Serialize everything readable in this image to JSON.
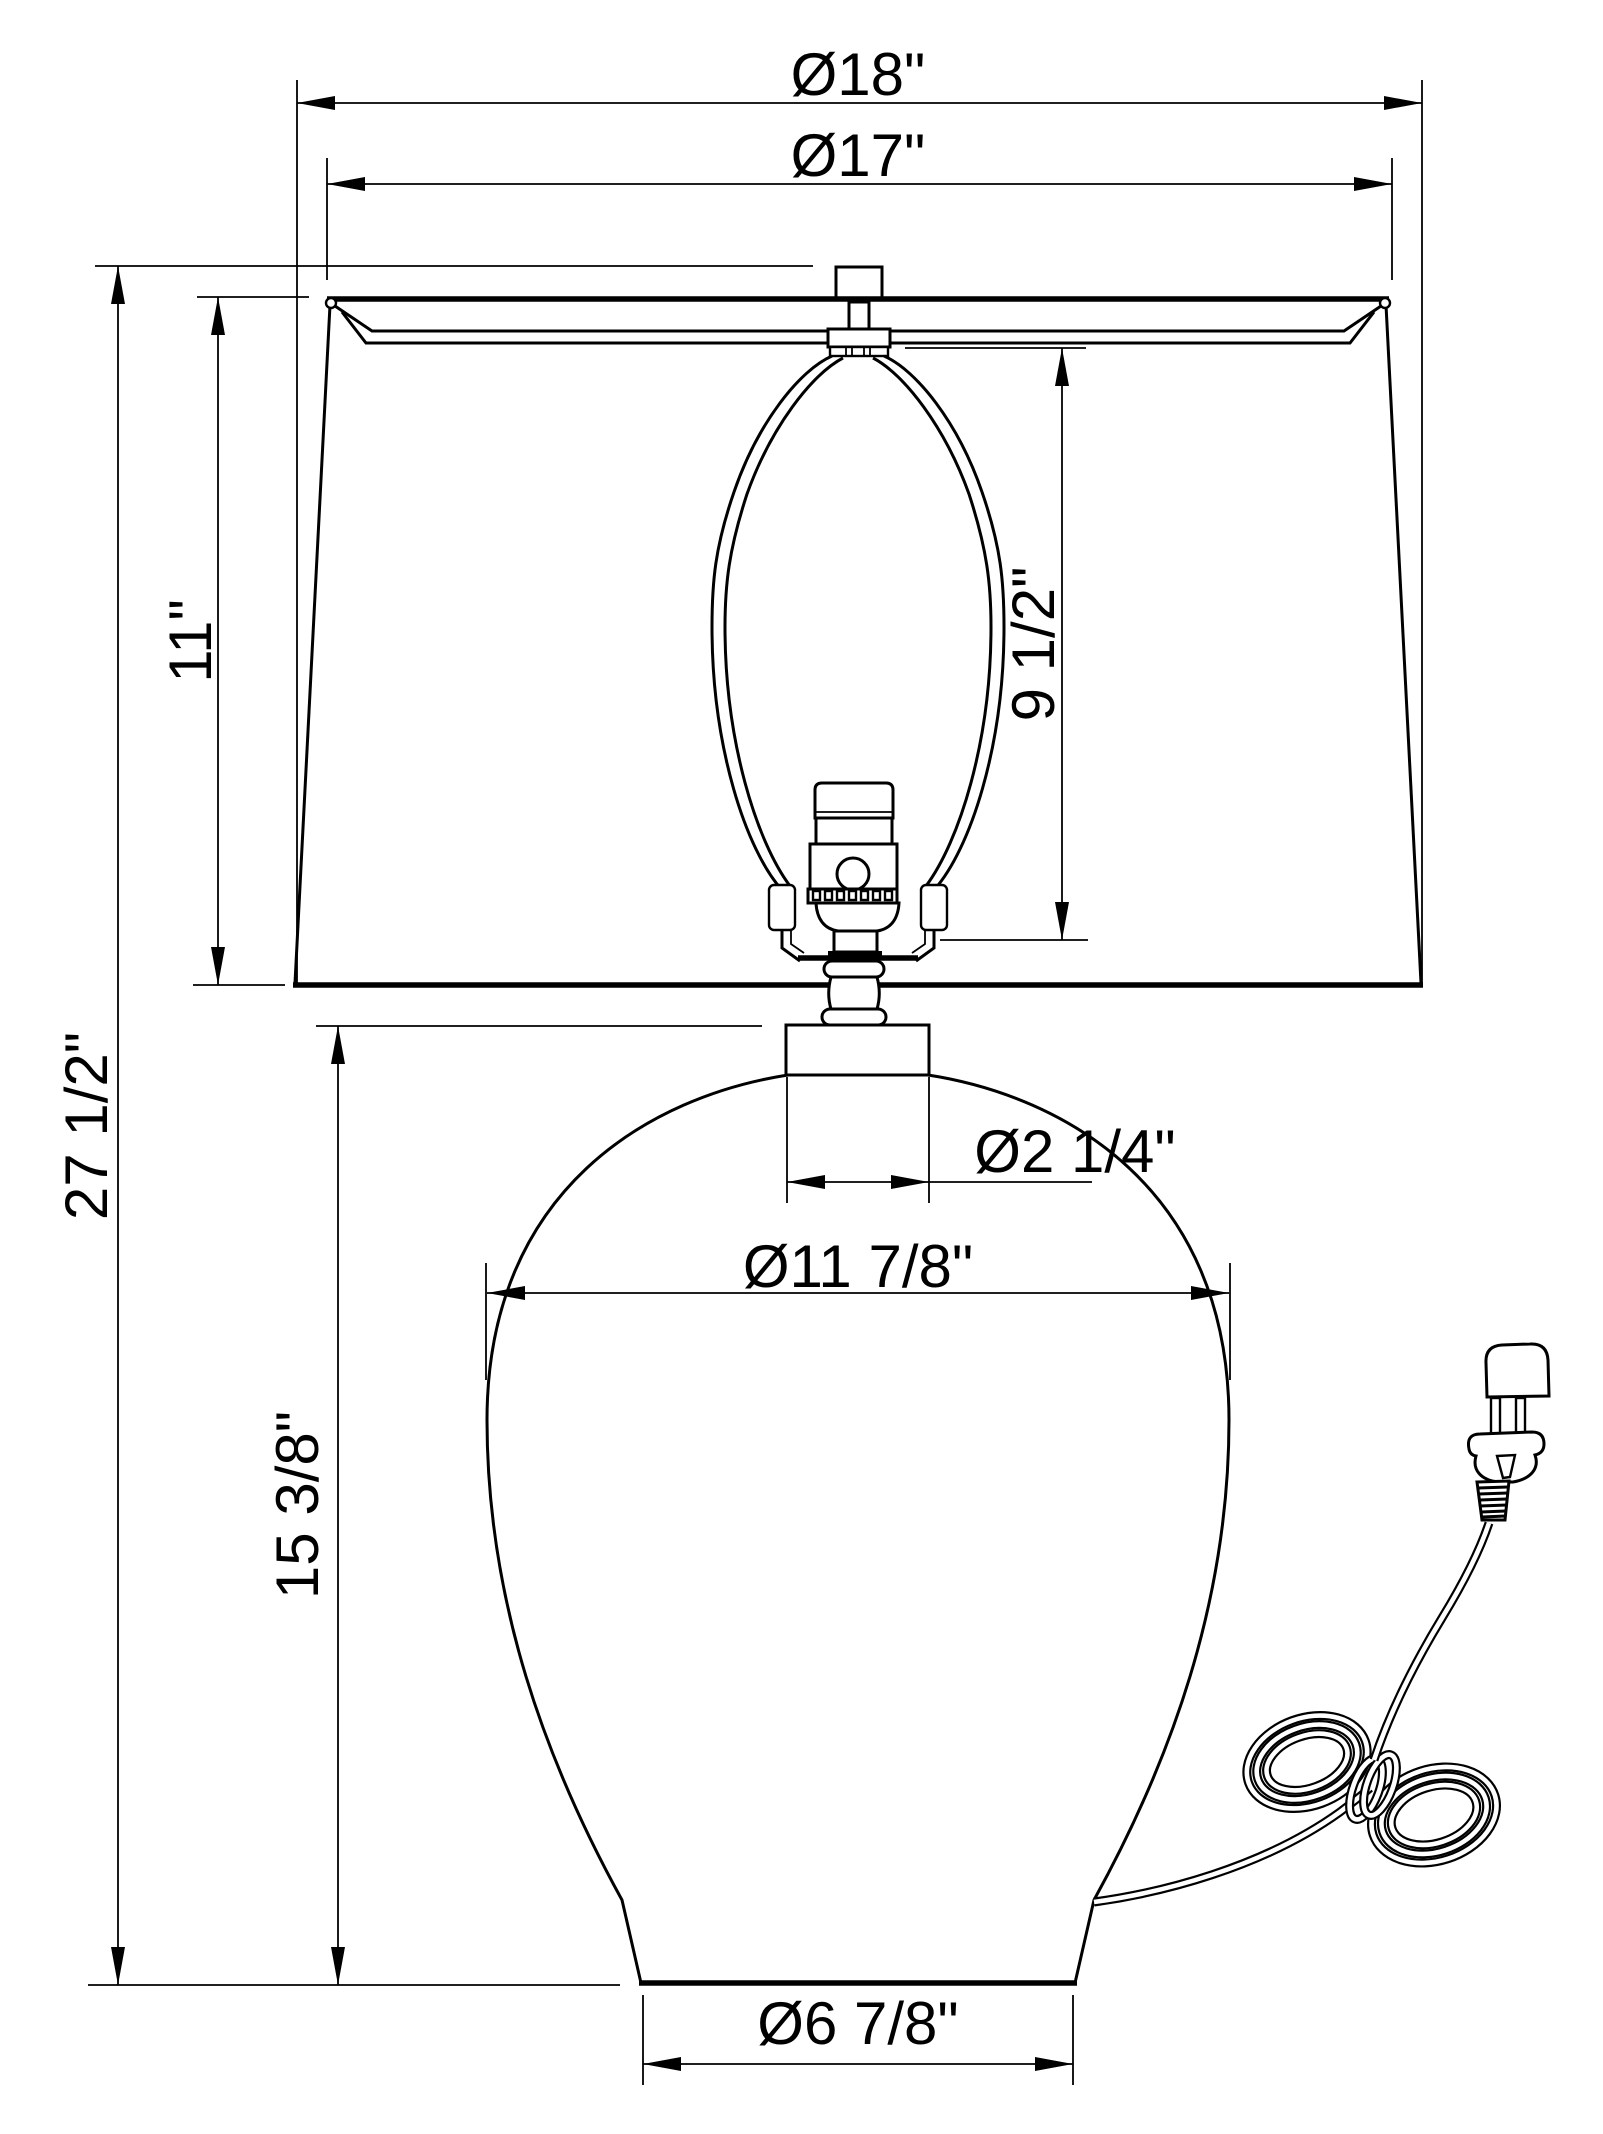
{
  "diagram": {
    "type": "technical-dimension-drawing",
    "subject": "table lamp with empire shade, harp, socket, urn body, cord and plug",
    "units": "inches",
    "background_color": "#ffffff",
    "line_color": "#000000"
  },
  "dimensions": {
    "shade_bottom_diameter": "Ø18\"",
    "shade_top_diameter": "Ø17\"",
    "shade_height": "11\"",
    "harp_height": "9 1/2\"",
    "overall_height": "27 1/2\"",
    "neck_diameter": "Ø2 1/4\"",
    "body_max_diameter": "Ø11 7/8\"",
    "body_height": "15 3/8\"",
    "base_diameter": "Ø6 7/8\""
  }
}
